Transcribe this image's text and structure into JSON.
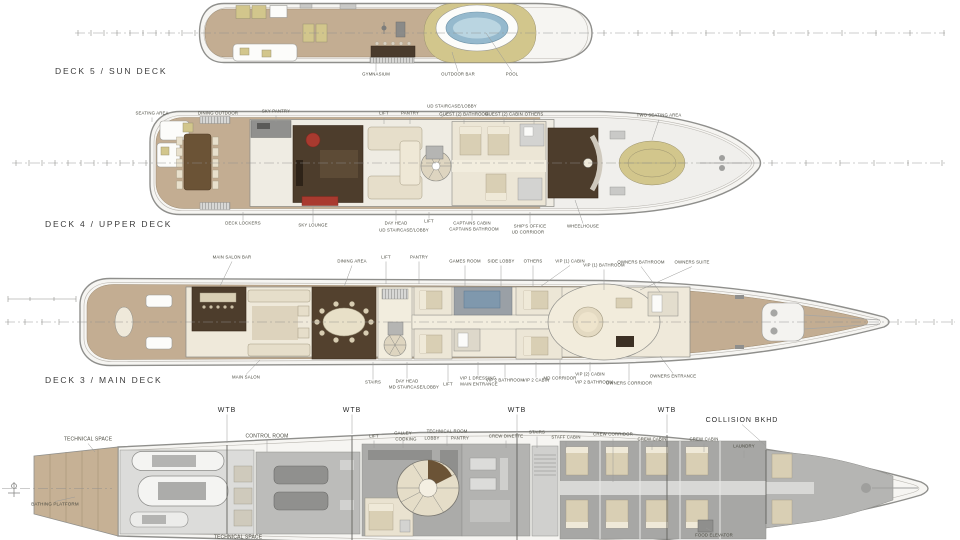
{
  "palette": {
    "teak_deck": "#c3ad92",
    "khaki_sunpad": "#d2c68c",
    "pool_water": "#95b9cd",
    "dark_wood_interior": "#4d3d2c",
    "red_accent": "#a93a2f",
    "cream_interior": "#efe9da",
    "crew_area_gray": "#ababa9",
    "hull_outline": "#8f8f8c"
  },
  "decks": [
    {
      "id": "deck5",
      "title": "DECK 5 / SUN DECK",
      "callouts": [
        {
          "t": "GYMNASIUM",
          "x": 376,
          "y": 75,
          "ly": 58
        },
        {
          "t": "OUTDOOR BAR",
          "x": 458,
          "y": 75,
          "ly": 52,
          "lx": 452
        },
        {
          "t": "POOL",
          "x": 512,
          "y": 75,
          "ly": 33,
          "lx": 486
        }
      ]
    },
    {
      "id": "deck4",
      "title": "DECK 4 / UPPER DECK",
      "callouts": [
        {
          "t": "SEATING AREA",
          "x": 152,
          "y": 114,
          "ly": 122
        },
        {
          "t": "DINING OUTDOOR",
          "x": 218,
          "y": 114,
          "ly": 124
        },
        {
          "t": "SKY PANTRY",
          "x": 276,
          "y": 112,
          "ly": 122
        },
        {
          "t": "LIFT",
          "x": 384,
          "y": 114,
          "ly": 124
        },
        {
          "t": "PANTRY",
          "x": 410,
          "y": 114,
          "ly": 124
        },
        {
          "t": "UD STAIRCASE/LOBBY",
          "x": 452,
          "y": 107,
          "ly": 118,
          "lx": 440
        },
        {
          "t": "GUEST (2) BATHROOM",
          "x": 464,
          "y": 115,
          "ly": 124
        },
        {
          "t": "GUEST (2) CABIN",
          "x": 504,
          "y": 115,
          "ly": 124
        },
        {
          "t": "OTHERS",
          "x": 534,
          "y": 115,
          "ly": 124
        },
        {
          "t": "TWO SEATING AREA",
          "x": 659,
          "y": 116,
          "ly": 140,
          "lx": 652
        },
        {
          "t": "DECK LOCKERS",
          "x": 243,
          "y": 224,
          "ly": 212
        },
        {
          "t": "SKY LOUNGE",
          "x": 313,
          "y": 226,
          "ly": 206
        },
        {
          "t": "DAY HEAD",
          "x": 396,
          "y": 224,
          "ly": 210
        },
        {
          "t": "UD STAIRCASE/LOBBY",
          "x": 404,
          "y": 231
        },
        {
          "t": "LIFT",
          "x": 429,
          "y": 222,
          "ly": 212
        },
        {
          "t": "CAPTAINS CABIN",
          "x": 472,
          "y": 224,
          "ly": 210
        },
        {
          "t": "CAPTAINS BATHROOM",
          "x": 474,
          "y": 230
        },
        {
          "t": "SHIP'S OFFICE",
          "x": 530,
          "y": 227,
          "ly": 212
        },
        {
          "t": "UD CORRIDOR",
          "x": 528,
          "y": 233
        },
        {
          "t": "WHEELHOUSE",
          "x": 583,
          "y": 227,
          "ly": 200,
          "lx": 575
        }
      ]
    },
    {
      "id": "deck3",
      "title": "DECK 3 / MAIN DECK",
      "callouts": [
        {
          "t": "MAIN SALON BAR",
          "x": 232,
          "y": 258,
          "ly": 286,
          "lx": 220
        },
        {
          "t": "DINING AREA",
          "x": 352,
          "y": 262,
          "ly": 287,
          "lx": 344
        },
        {
          "t": "LIFT",
          "x": 386,
          "y": 258,
          "ly": 284
        },
        {
          "t": "PANTRY",
          "x": 419,
          "y": 258,
          "ly": 284
        },
        {
          "t": "GAMES ROOM",
          "x": 465,
          "y": 262,
          "ly": 287
        },
        {
          "t": "SIDE LOBBY",
          "x": 501,
          "y": 262,
          "ly": 287
        },
        {
          "t": "OTHERS",
          "x": 533,
          "y": 262,
          "ly": 287
        },
        {
          "t": "VIP (1) CABIN",
          "x": 570,
          "y": 262,
          "ly": 287,
          "lx": 540
        },
        {
          "t": "VIP (1) BATHROOM",
          "x": 604,
          "y": 266,
          "ly": 290
        },
        {
          "t": "OWNERS BATHROOM",
          "x": 641,
          "y": 263,
          "ly": 292,
          "lx": 660
        },
        {
          "t": "OWNERS SUITE",
          "x": 692,
          "y": 263,
          "ly": 290,
          "lx": 640
        },
        {
          "t": "MAIN SALON",
          "x": 246,
          "y": 378,
          "ly": 360,
          "lx": 260
        },
        {
          "t": "STAIRS",
          "x": 373,
          "y": 383,
          "ly": 362
        },
        {
          "t": "DAY HEAD",
          "x": 407,
          "y": 382,
          "ly": 362
        },
        {
          "t": "MD STAIRCASE/LOBBY",
          "x": 414,
          "y": 388
        },
        {
          "t": "LIFT",
          "x": 448,
          "y": 385,
          "ly": 364
        },
        {
          "t": "VIP 1 DRESSING",
          "x": 478,
          "y": 379,
          "ly": 362
        },
        {
          "t": "MAIN ENTRANCE",
          "x": 479,
          "y": 385
        },
        {
          "t": "VIP 2 BATHROOM",
          "x": 505,
          "y": 381,
          "ly": 364
        },
        {
          "t": "VIP 2 CABIN",
          "x": 536,
          "y": 381,
          "ly": 362
        },
        {
          "t": "MD CORRIDOR",
          "x": 560,
          "y": 379,
          "ly": 360
        },
        {
          "t": "VIP (2) CABIN",
          "x": 590,
          "y": 375,
          "ly": 362
        },
        {
          "t": "VIP 2 BATHROOM",
          "x": 594,
          "y": 383
        },
        {
          "t": "OWNERS CORRIDOR",
          "x": 629,
          "y": 384,
          "ly": 364
        },
        {
          "t": "OWNERS ENTRANCE",
          "x": 673,
          "y": 377,
          "ly": 356,
          "lx": 660
        }
      ]
    },
    {
      "id": "lower",
      "title": "",
      "markers": [
        {
          "t": "WTB",
          "x": 227,
          "y": 411,
          "big": true,
          "ly": 443
        },
        {
          "t": "WTB",
          "x": 352,
          "y": 411,
          "big": true,
          "ly": 434
        },
        {
          "t": "WTB",
          "x": 517,
          "y": 411,
          "big": true,
          "ly": 431
        },
        {
          "t": "WTB",
          "x": 667,
          "y": 411,
          "big": true,
          "ly": 433
        },
        {
          "t": "COLLISION BKHD",
          "x": 742,
          "y": 421,
          "big": true,
          "ly": 446,
          "lx": 766
        }
      ],
      "callouts": [
        {
          "t": "TECHNICAL SPACE",
          "x": 88,
          "y": 440,
          "fs": 5,
          "ly": 452,
          "lx": 95
        },
        {
          "t": "CONTROL ROOM",
          "x": 267,
          "y": 437,
          "fs": 5,
          "ly": 452
        },
        {
          "t": "LIFT",
          "x": 374,
          "y": 437,
          "ly": 448
        },
        {
          "t": "GALLEY",
          "x": 403,
          "y": 434,
          "ly": 448
        },
        {
          "t": "COOKING",
          "x": 406,
          "y": 440
        },
        {
          "t": "TECHNICAL ROOM",
          "x": 447,
          "y": 432,
          "ly": 446
        },
        {
          "t": "LOBBY",
          "x": 432,
          "y": 439
        },
        {
          "t": "PANTRY",
          "x": 460,
          "y": 439
        },
        {
          "t": "CREW DINETTE",
          "x": 506,
          "y": 437,
          "ly": 448
        },
        {
          "t": "STAIRS",
          "x": 537,
          "y": 433,
          "ly": 448
        },
        {
          "t": "STAFF CABIN",
          "x": 566,
          "y": 438,
          "ly": 448
        },
        {
          "t": "CREW CORRIDOR",
          "x": 613,
          "y": 435,
          "ly": 482
        },
        {
          "t": "CREW CABIN",
          "x": 652,
          "y": 440,
          "ly": 450
        },
        {
          "t": "CREW CABIN",
          "x": 704,
          "y": 440,
          "ly": 452
        },
        {
          "t": "LAUNDRY",
          "x": 744,
          "y": 447,
          "ly": 458
        },
        {
          "t": "BATHING PLATFORM",
          "x": 55,
          "y": 505,
          "fs": 4.5,
          "ly": 497,
          "lx": 75
        },
        {
          "t": "TECHNICAL SPACE",
          "x": 238,
          "y": 538,
          "fs": 5
        },
        {
          "t": "FOOD ELEVATOR",
          "x": 714,
          "y": 536,
          "ly": 528,
          "lx": 706
        }
      ]
    }
  ]
}
